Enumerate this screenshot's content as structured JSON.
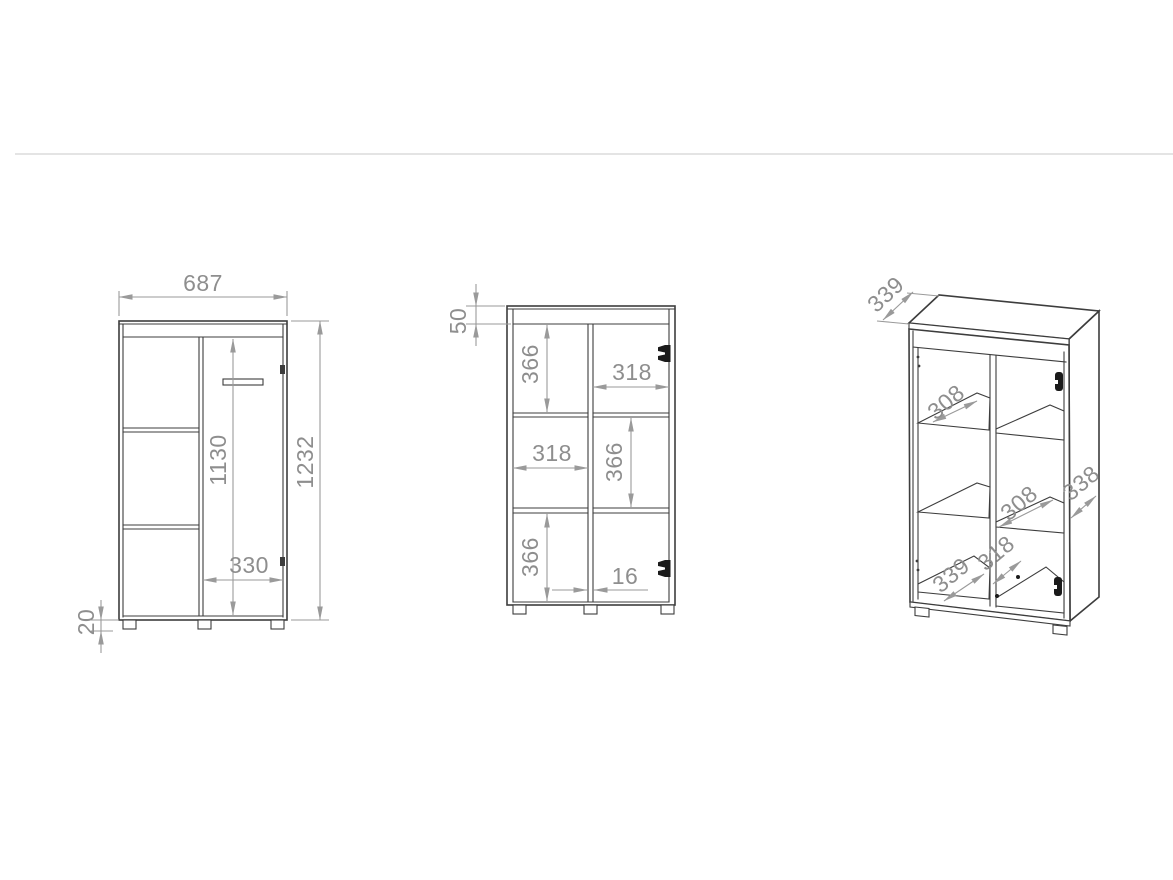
{
  "drawing": {
    "kind": "furniture-technical-drawing",
    "colors": {
      "line": "#3d3d3d",
      "dimension": "#9a9a9a",
      "dimension_text": "#8e8e8e",
      "background": "#ffffff",
      "separator": "#dcdcdc",
      "hinge": "#1a1a1a"
    },
    "views": {
      "front": {
        "label": "front view (door closed)",
        "width": "687",
        "height": "1232",
        "door_height": "1130",
        "door_width": "330",
        "feet_height": "20"
      },
      "front_open": {
        "label": "front view (door open / internal)",
        "top_panel_height": "50",
        "top_left_cell_height": "366",
        "top_right_cell_width": "318",
        "middle_left_cell_width": "318",
        "middle_right_cell_height": "366",
        "bottom_left_cell_height": "366",
        "divider_thickness": "16"
      },
      "isometric": {
        "label": "isometric view",
        "top_depth": "339",
        "upper_shelf_depth": "308",
        "lower_shelf_depth": "308",
        "side_panel_depth": "338",
        "interior_depth": "318",
        "bottom_depth": "339"
      }
    }
  }
}
